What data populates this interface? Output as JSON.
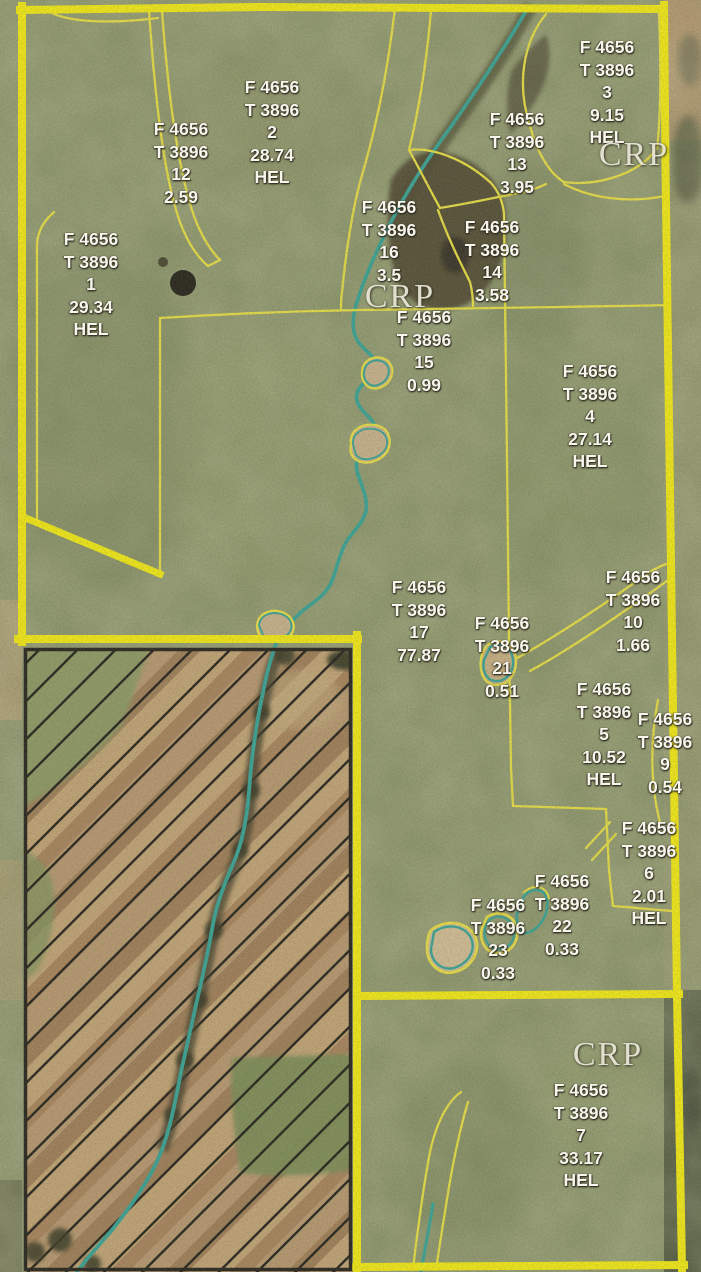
{
  "map": {
    "farm_number": "F 4656",
    "tract_number": "T 3896",
    "hel_text": "HEL",
    "colors": {
      "boundary_yellow_thick": "#f9ef05",
      "boundary_yellow_thin": "#ece23a",
      "stream_teal": "#2aa093",
      "label_white": "#f7f5ec",
      "crp_label_gray": "#e6e4d4",
      "hatch_black": "#12100a",
      "aerial_olive": "#859062",
      "bare_soil_tan": "#c2a170"
    },
    "field_labels": [
      {
        "farm": "F 4656",
        "tract": "T 3896",
        "field": "12",
        "acres": "2.59",
        "hel": "",
        "x": 181,
        "y": 118
      },
      {
        "farm": "F 4656",
        "tract": "T 3896",
        "field": "2",
        "acres": "28.74",
        "hel": "HEL",
        "x": 272,
        "y": 76
      },
      {
        "farm": "F 4656",
        "tract": "T 3896",
        "field": "3",
        "acres": "9.15",
        "hel": "HEL",
        "x": 607,
        "y": 36
      },
      {
        "farm": "F 4656",
        "tract": "T 3896",
        "field": "13",
        "acres": "3.95",
        "hel": "",
        "x": 517,
        "y": 108
      },
      {
        "farm": "F 4656",
        "tract": "T 3896",
        "field": "16",
        "acres": "3.5",
        "hel": "",
        "x": 389,
        "y": 196
      },
      {
        "farm": "F 4656",
        "tract": "T 3896",
        "field": "14",
        "acres": "3.58",
        "hel": "",
        "x": 492,
        "y": 216
      },
      {
        "farm": "F 4656",
        "tract": "T 3896",
        "field": "1",
        "acres": "29.34",
        "hel": "HEL",
        "x": 91,
        "y": 228
      },
      {
        "farm": "F 4656",
        "tract": "T 3896",
        "field": "15",
        "acres": "0.99",
        "hel": "",
        "x": 424,
        "y": 306
      },
      {
        "farm": "F 4656",
        "tract": "T 3896",
        "field": "4",
        "acres": "27.14",
        "hel": "HEL",
        "x": 590,
        "y": 360
      },
      {
        "farm": "F 4656",
        "tract": "T 3896",
        "field": "17",
        "acres": "77.87",
        "hel": "",
        "x": 419,
        "y": 576
      },
      {
        "farm": "F 4656",
        "tract": "T 3896",
        "field": "10",
        "acres": "1.66",
        "hel": "",
        "x": 633,
        "y": 566
      },
      {
        "farm": "F 4656",
        "tract": "T 3896",
        "field": "21",
        "acres": "0.51",
        "hel": "",
        "x": 502,
        "y": 612
      },
      {
        "farm": "F 4656",
        "tract": "T 3896",
        "field": "5",
        "acres": "10.52",
        "hel": "HEL",
        "x": 604,
        "y": 678
      },
      {
        "farm": "F 4656",
        "tract": "T 3896",
        "field": "9",
        "acres": "0.54",
        "hel": "",
        "x": 665,
        "y": 708
      },
      {
        "farm": "F 4656",
        "tract": "T 3896",
        "field": "6",
        "acres": "2.01",
        "hel": "HEL",
        "x": 649,
        "y": 817
      },
      {
        "farm": "F 4656",
        "tract": "T 3896",
        "field": "22",
        "acres": "0.33",
        "hel": "",
        "x": 562,
        "y": 870
      },
      {
        "farm": "F 4656",
        "tract": "T 3896",
        "field": "23",
        "acres": "0.33",
        "hel": "",
        "x": 498,
        "y": 894
      },
      {
        "farm": "F 4656",
        "tract": "T 3896",
        "field": "7",
        "acres": "33.17",
        "hel": "HEL",
        "x": 581,
        "y": 1079
      }
    ],
    "crp_labels": [
      {
        "text": "CRP",
        "x": 634,
        "y": 138
      },
      {
        "text": "CRP",
        "x": 400,
        "y": 280
      },
      {
        "text": "CRP",
        "x": 608,
        "y": 1038
      }
    ]
  }
}
